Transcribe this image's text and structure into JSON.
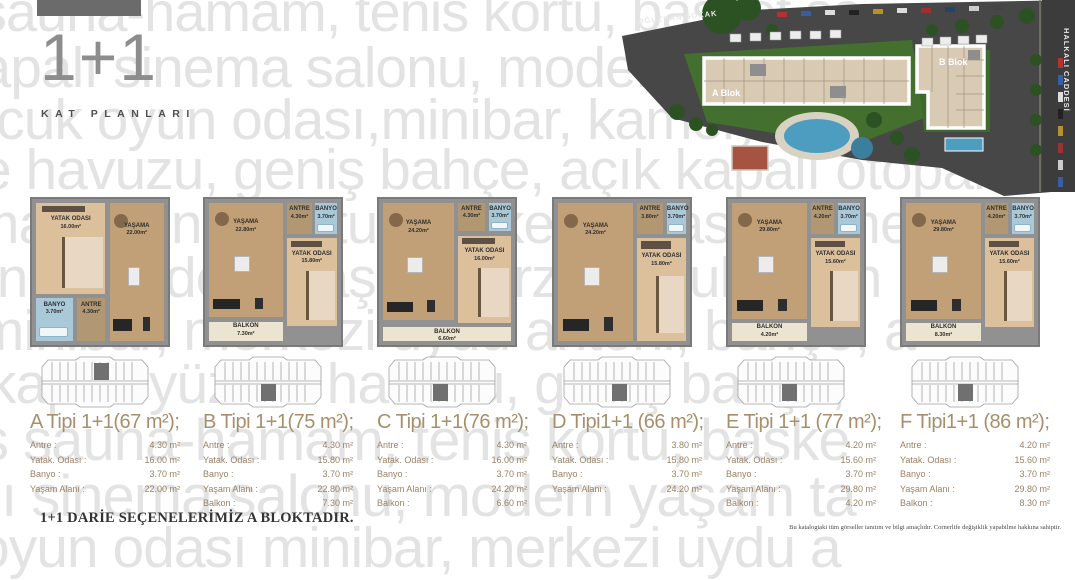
{
  "header": {
    "series_title": "1+1",
    "subtitle": "KAT PLANLARI"
  },
  "site_plan": {
    "street_left": "OĞUZHAN SOKAK",
    "street_right": "HALKALI CADDESİ",
    "block_a": "A Blok",
    "block_b": "B Blok"
  },
  "watermark": {
    "color": "#e3e3e3",
    "lines": [
      {
        "text": "ness sauna-hamam, tenis kortu, basket sa",
        "x": -150,
        "y": -16,
        "size": 56
      },
      {
        "text": "kapalı sinema salonu, modern tarzı,",
        "x": -48,
        "y": 40,
        "size": 57
      },
      {
        "text": "çocuk oyun odası,minibar, kamelya",
        "x": -62,
        "y": 92,
        "size": 57
      },
      {
        "text": "e havuzu, geniş bahçe, açık kapalı otopark",
        "x": -20,
        "y": 142,
        "size": 57
      },
      {
        "text": "mam, tenis kortu, basket sahası, kame",
        "x": -28,
        "y": 196,
        "size": 57
      },
      {
        "text": "onu, modern yaşam tarzı, çocuk oyun",
        "x": -34,
        "y": 250,
        "size": 57
      },
      {
        "text": ",minibar, merkezi uydu anteni, bahçe, a",
        "x": -38,
        "y": 303,
        "size": 57
      },
      {
        "text": "-kapalı yüzme havuzu, geniş bahçe,",
        "x": -30,
        "y": 356,
        "size": 57
      },
      {
        "text": "ss sauna-hamam, tenis kortu, baske",
        "x": -48,
        "y": 412,
        "size": 58
      },
      {
        "text": "alı sinema salonu, modern yaşam ta",
        "x": -42,
        "y": 468,
        "size": 58
      },
      {
        "text": "oyun odası minibar, merkezi uydu a",
        "x": -22,
        "y": 520,
        "size": 57
      }
    ]
  },
  "plans": [
    {
      "id": "A",
      "title": "A Tipi 1+1(67 m²);",
      "kx": 58,
      "krow": "top",
      "rooms": [
        {
          "name": "YATAK ODASI",
          "area": "16.00m²",
          "type": "bedroom",
          "x": 3,
          "y": 3,
          "w": 51,
          "h": 62
        },
        {
          "name": "YAŞAMA",
          "area": "22.00m²",
          "type": "living",
          "x": 57,
          "y": 3,
          "w": 40,
          "h": 94
        },
        {
          "name": "BANYO",
          "area": "3.70m²",
          "type": "bath",
          "x": 3,
          "y": 68,
          "w": 27,
          "h": 29
        },
        {
          "name": "ANTRE",
          "area": "4.30m²",
          "type": "hall",
          "x": 33,
          "y": 68,
          "w": 21,
          "h": 29
        }
      ],
      "specs": [
        {
          "label": "Antre :",
          "value": "4.30 m²"
        },
        {
          "label": "Yatak. Odası :",
          "value": "16.00 m²"
        },
        {
          "label": "Banyo :",
          "value": "3.70 m²"
        },
        {
          "label": "Yaşam Alanı :",
          "value": "22.00 m²"
        }
      ]
    },
    {
      "id": "B",
      "title": "B Tipi 1+1(75 m²);",
      "kx": 52,
      "krow": "bottom",
      "rooms": [
        {
          "name": "YAŞAMA",
          "area": "22.80m²",
          "type": "living",
          "x": 3,
          "y": 3,
          "w": 54,
          "h": 78
        },
        {
          "name": "ANTRE",
          "area": "4.30m²",
          "type": "hall",
          "x": 60,
          "y": 3,
          "w": 19,
          "h": 21
        },
        {
          "name": "BANYO",
          "area": "3.70m²",
          "type": "bath",
          "x": 81,
          "y": 3,
          "w": 16,
          "h": 21
        },
        {
          "name": "YATAK ODASI",
          "area": "15.80m²",
          "type": "bedroom",
          "x": 60,
          "y": 27,
          "w": 37,
          "h": 60
        },
        {
          "name": "BALKON",
          "area": "7.30m²",
          "type": "balcony",
          "x": 3,
          "y": 84,
          "w": 54,
          "h": 13
        }
      ],
      "specs": [
        {
          "label": "Antre :",
          "value": "4.30 m²"
        },
        {
          "label": "Yatak. Odası :",
          "value": "15.80 m²"
        },
        {
          "label": "Banyo :",
          "value": "3.70 m²"
        },
        {
          "label": "Yaşam Alanı :",
          "value": "22.80 m²"
        },
        {
          "label": "Balkon :",
          "value": "7.30 m²"
        }
      ]
    },
    {
      "id": "C",
      "title": "C Tipi 1+1(76 m²);",
      "kx": 50,
      "krow": "bottom",
      "rooms": [
        {
          "name": "YAŞAMA",
          "area": "24.20m²",
          "type": "living",
          "x": 3,
          "y": 3,
          "w": 52,
          "h": 80
        },
        {
          "name": "ANTRE",
          "area": "4.30m²",
          "type": "hall",
          "x": 58,
          "y": 3,
          "w": 20,
          "h": 19
        },
        {
          "name": "BANYO",
          "area": "3.70m²",
          "type": "bath",
          "x": 81,
          "y": 3,
          "w": 16,
          "h": 19
        },
        {
          "name": "YATAK ODASI",
          "area": "16.00m²",
          "type": "bedroom",
          "x": 58,
          "y": 25,
          "w": 39,
          "h": 60
        },
        {
          "name": "BALKON",
          "area": "6.60m²",
          "type": "balcony",
          "x": 3,
          "y": 88,
          "w": 94,
          "h": 9
        }
      ],
      "specs": [
        {
          "label": "Antre :",
          "value": "4.30 m²"
        },
        {
          "label": "Yatak. Odası :",
          "value": "16.00 m²"
        },
        {
          "label": "Banyo :",
          "value": "3.70 m²"
        },
        {
          "label": "Yaşam Alanı :",
          "value": "24.20 m²"
        },
        {
          "label": "Balkon :",
          "value": "6.60 m²"
        }
      ]
    },
    {
      "id": "D",
      "title": "D Tipi1+1 (66 m²);",
      "kx": 54,
      "krow": "bottom",
      "rooms": [
        {
          "name": "YAŞAMA",
          "area": "24.20m²",
          "type": "living",
          "x": 3,
          "y": 3,
          "w": 55,
          "h": 94
        },
        {
          "name": "ANTRE",
          "area": "3.80m²",
          "type": "hall",
          "x": 61,
          "y": 3,
          "w": 19,
          "h": 21
        },
        {
          "name": "BANYO",
          "area": "3.70m²",
          "type": "bath",
          "x": 83,
          "y": 3,
          "w": 14,
          "h": 21
        },
        {
          "name": "YATAK ODASI",
          "area": "15.80m²",
          "type": "bedroom",
          "x": 61,
          "y": 27,
          "w": 36,
          "h": 70
        }
      ],
      "specs": [
        {
          "label": "Antre :",
          "value": "3.80 m²"
        },
        {
          "label": "Yatak. Odası :",
          "value": "15.80 m²"
        },
        {
          "label": "Banyo :",
          "value": "3.70 m²"
        },
        {
          "label": "Yaşam Alanı :",
          "value": "24.20 m²"
        }
      ]
    },
    {
      "id": "E",
      "title": "E Tipi 1+1 (77 m²);",
      "kx": 50,
      "krow": "bottom",
      "rooms": [
        {
          "name": "YAŞAMA",
          "area": "29.80m²",
          "type": "living",
          "x": 3,
          "y": 3,
          "w": 55,
          "h": 79
        },
        {
          "name": "ANTRE",
          "area": "4.20m²",
          "type": "hall",
          "x": 61,
          "y": 3,
          "w": 17,
          "h": 21
        },
        {
          "name": "BANYO",
          "area": "3.70m²",
          "type": "bath",
          "x": 81,
          "y": 3,
          "w": 16,
          "h": 21
        },
        {
          "name": "YATAK ODASI",
          "area": "15.60m²",
          "type": "bedroom",
          "x": 61,
          "y": 27,
          "w": 36,
          "h": 61
        },
        {
          "name": "BALKON",
          "area": "4.20m²",
          "type": "balcony",
          "x": 3,
          "y": 85,
          "w": 55,
          "h": 12
        }
      ],
      "specs": [
        {
          "label": "Antre :",
          "value": "4.20 m²"
        },
        {
          "label": "Yatak. Odası :",
          "value": "15.60 m²"
        },
        {
          "label": "Banyo :",
          "value": "3.70 m²"
        },
        {
          "label": "Yaşam Alanı :",
          "value": "29.80 m²"
        },
        {
          "label": "Balkon :",
          "value": "4.20 m²"
        }
      ]
    },
    {
      "id": "F",
      "title": "F Tipi1+1 (86 m²);",
      "kx": 52,
      "krow": "bottom",
      "rooms": [
        {
          "name": "YAŞAMA",
          "area": "29.80m²",
          "type": "living",
          "x": 3,
          "y": 3,
          "w": 55,
          "h": 79
        },
        {
          "name": "ANTRE",
          "area": "4.20m²",
          "type": "hall",
          "x": 61,
          "y": 3,
          "w": 17,
          "h": 21
        },
        {
          "name": "BANYO",
          "area": "3.70m²",
          "type": "bath",
          "x": 81,
          "y": 3,
          "w": 16,
          "h": 21
        },
        {
          "name": "YATAK ODASI",
          "area": "15.60m²",
          "type": "bedroom",
          "x": 61,
          "y": 27,
          "w": 36,
          "h": 61
        },
        {
          "name": "BALKON",
          "area": "8.30m²",
          "type": "balcony",
          "x": 3,
          "y": 85,
          "w": 55,
          "h": 12
        }
      ],
      "specs": [
        {
          "label": "Antre :",
          "value": "4.20 m²"
        },
        {
          "label": "Yatak. Odası :",
          "value": "15.60 m²"
        },
        {
          "label": "Banyo :",
          "value": "3.70 m²"
        },
        {
          "label": "Yaşam Alanı :",
          "value": "29.80 m²"
        },
        {
          "label": "Balkon :",
          "value": "8.30 m²"
        }
      ]
    }
  ],
  "footer": {
    "note": "1+1 DARİE SEÇENELERİMİZ A BLOKTADIR.",
    "disclaimer": "Bu katalogtaki tüm görseller tanıtım ve bilgi amaçlıdır. Cornerlife değişiklik yapabilme hakkına sahiptir."
  }
}
